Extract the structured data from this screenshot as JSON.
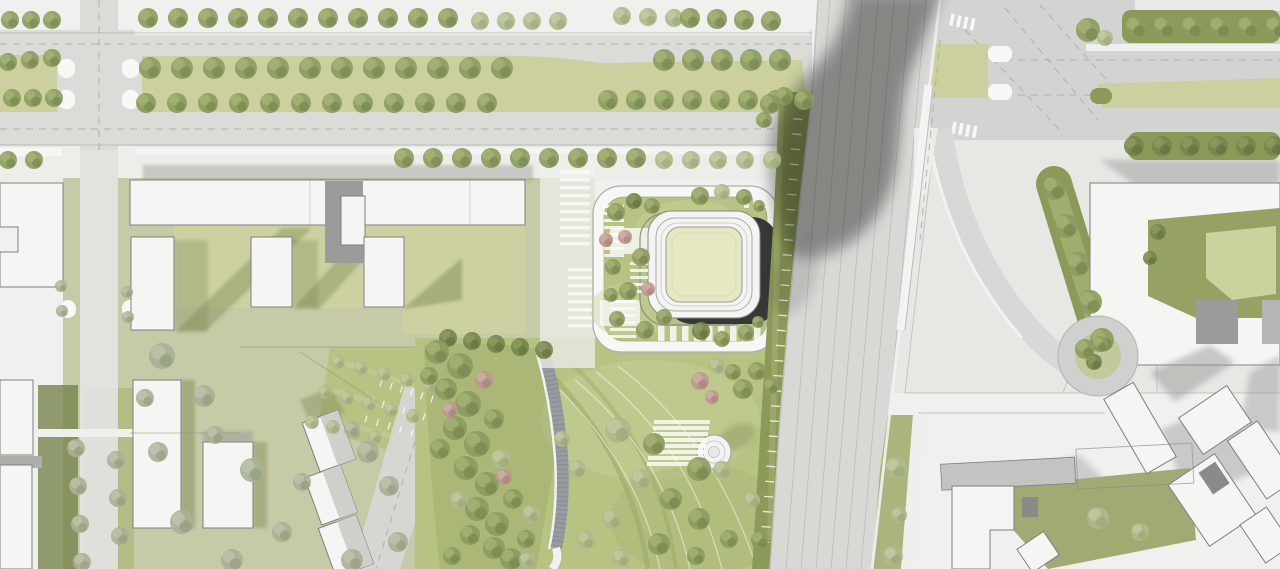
{
  "scene": {
    "kind": "architectural-site-plan",
    "description": "aerial-masterplan-rendering",
    "width": 1280,
    "height": 569
  },
  "palette": {
    "bg": "#F0F0EE",
    "road": "#DBDCD8",
    "roadDark": "#D3D4D1",
    "white": "#F8F8F6",
    "building": "#F5F5F3",
    "buildingStroke": "#7E7F81",
    "grayRoof": "#C3C4C1",
    "grayShadow": "#9A9A98",
    "oliveShadow": "#77854E",
    "lawnYellow": "#CBD09E",
    "lawnSage": "#C6CAA7",
    "lawnBright": "#B7C382",
    "lawnMid": "#AFBA80",
    "hedge": "#8B9A58",
    "courtyard": "#E5E8C3",
    "darkFacade": "#373736",
    "gravel": "#969CA0",
    "lineGray": "#A7A8A4",
    "towerShadow": "#6B6B69"
  },
  "vegetation": {
    "tree_types": {
      "olive": {
        "fill": "#8C9B60",
        "hi": "#A9B878",
        "sh": "#6F7E48"
      },
      "light": {
        "fill": "#AFBA8C",
        "hi": "#C6CEA6",
        "sh": "#95A172"
      },
      "gray": {
        "fill": "#A9B195",
        "hi": "#C2C8B0",
        "sh": "#8C957A"
      },
      "pink": {
        "fill": "#BD9890",
        "hi": "#D2B3AB",
        "sh": "#A07B73"
      },
      "dark": {
        "fill": "#76864C",
        "hi": "#8FA063",
        "sh": "#5C6B3A"
      }
    },
    "tree_rows": [
      {
        "x": 10,
        "y": 20,
        "dx": 21,
        "dy": 0,
        "n": 3,
        "r": 9,
        "t": "olive"
      },
      {
        "x": 148,
        "y": 18,
        "dx": 30,
        "dy": 0,
        "n": 11,
        "r": 10,
        "t": "olive"
      },
      {
        "x": 480,
        "y": 21,
        "dx": 26,
        "dy": 0,
        "n": 4,
        "r": 9,
        "t": "light"
      },
      {
        "x": 622,
        "y": 16,
        "dx": 26,
        "dy": 1,
        "n": 3,
        "r": 9,
        "t": "light"
      },
      {
        "x": 690,
        "y": 18,
        "dx": 27,
        "dy": 1,
        "n": 4,
        "r": 10,
        "t": "olive"
      },
      {
        "x": 8,
        "y": 62,
        "dx": 22,
        "dy": -2,
        "n": 3,
        "r": 9,
        "t": "olive"
      },
      {
        "x": 12,
        "y": 98,
        "dx": 21,
        "dy": 0,
        "n": 3,
        "r": 9,
        "t": "olive"
      },
      {
        "x": 150,
        "y": 68,
        "dx": 32,
        "dy": 0,
        "n": 12,
        "r": 11,
        "t": "olive"
      },
      {
        "x": 146,
        "y": 103,
        "dx": 31,
        "dy": 0,
        "n": 12,
        "r": 10,
        "t": "olive"
      },
      {
        "x": 664,
        "y": 60,
        "dx": 29,
        "dy": 0,
        "n": 5,
        "r": 11,
        "t": "olive"
      },
      {
        "x": 608,
        "y": 100,
        "dx": 28,
        "dy": 0,
        "n": 8,
        "r": 10,
        "t": "olive"
      },
      {
        "x": 8,
        "y": 160,
        "dx": 26,
        "dy": 0,
        "n": 2,
        "r": 9,
        "t": "olive"
      },
      {
        "x": 404,
        "y": 158,
        "dx": 29,
        "dy": 0,
        "n": 9,
        "r": 10,
        "t": "olive"
      },
      {
        "x": 664,
        "y": 160,
        "dx": 27,
        "dy": 0,
        "n": 5,
        "r": 9,
        "t": "light"
      },
      {
        "x": 1136,
        "y": 27,
        "dx": 28,
        "dy": 0,
        "n": 6,
        "r": 11,
        "t": "olive"
      },
      {
        "x": 1134,
        "y": 146,
        "dx": 28,
        "dy": 0,
        "n": 6,
        "r": 10,
        "t": "dark"
      },
      {
        "x": 1054,
        "y": 188,
        "dx": 12,
        "dy": 38,
        "n": 5,
        "r": 12,
        "t": "olive"
      },
      {
        "x": 61,
        "y": 286,
        "dx": 1,
        "dy": 25,
        "n": 2,
        "r": 6,
        "t": "gray"
      },
      {
        "x": 127,
        "y": 292,
        "dx": 1,
        "dy": 25,
        "n": 2,
        "r": 6,
        "t": "gray"
      },
      {
        "x": 76,
        "y": 448,
        "dx": 2,
        "dy": 38,
        "n": 4,
        "r": 9,
        "t": "gray"
      },
      {
        "x": 116,
        "y": 460,
        "dx": 2,
        "dy": 38,
        "n": 3,
        "r": 9,
        "t": "gray"
      },
      {
        "x": 338,
        "y": 362,
        "dx": 23,
        "dy": 6,
        "n": 5,
        "r": 7,
        "t": "light"
      },
      {
        "x": 325,
        "y": 392,
        "dx": 22,
        "dy": 6,
        "n": 5,
        "r": 7,
        "t": "light"
      },
      {
        "x": 312,
        "y": 422,
        "dx": 21,
        "dy": 5,
        "n": 4,
        "r": 7,
        "t": "light"
      },
      {
        "x": 448,
        "y": 338,
        "dx": 24,
        "dy": 3,
        "n": 5,
        "r": 9,
        "t": "dark"
      }
    ],
    "trees": [
      [
        616,
        212,
        9,
        "olive"
      ],
      [
        634,
        201,
        8,
        "dark"
      ],
      [
        652,
        206,
        8,
        "olive"
      ],
      [
        606,
        240,
        7,
        "pink"
      ],
      [
        625,
        237,
        7,
        "pink"
      ],
      [
        641,
        257,
        9,
        "olive"
      ],
      [
        613,
        267,
        8,
        "olive"
      ],
      [
        611,
        295,
        7,
        "olive"
      ],
      [
        628,
        291,
        9,
        "olive"
      ],
      [
        617,
        319,
        8,
        "olive"
      ],
      [
        645,
        330,
        9,
        "olive"
      ],
      [
        664,
        317,
        8,
        "olive"
      ],
      [
        648,
        289,
        7,
        "pink"
      ],
      [
        700,
        196,
        9,
        "olive"
      ],
      [
        722,
        192,
        8,
        "light"
      ],
      [
        744,
        197,
        8,
        "olive"
      ],
      [
        759,
        206,
        6,
        "olive"
      ],
      [
        701,
        331,
        9,
        "dark"
      ],
      [
        722,
        339,
        8,
        "olive"
      ],
      [
        746,
        333,
        8,
        "olive"
      ],
      [
        758,
        322,
        6,
        "olive"
      ],
      [
        700,
        381,
        9,
        "pink"
      ],
      [
        717,
        366,
        8,
        "light"
      ],
      [
        743,
        389,
        10,
        "olive"
      ],
      [
        712,
        397,
        7,
        "pink"
      ],
      [
        733,
        372,
        8,
        "olive"
      ],
      [
        757,
        371,
        9,
        "olive"
      ],
      [
        771,
        386,
        8,
        "olive"
      ],
      [
        437,
        352,
        12,
        "olive"
      ],
      [
        460,
        366,
        13,
        "olive"
      ],
      [
        446,
        389,
        11,
        "olive"
      ],
      [
        468,
        404,
        13,
        "olive"
      ],
      [
        484,
        380,
        9,
        "pink"
      ],
      [
        455,
        428,
        12,
        "olive"
      ],
      [
        477,
        444,
        13,
        "olive"
      ],
      [
        494,
        419,
        10,
        "olive"
      ],
      [
        466,
        468,
        12,
        "olive"
      ],
      [
        487,
        484,
        12,
        "olive"
      ],
      [
        501,
        459,
        10,
        "light"
      ],
      [
        477,
        509,
        12,
        "olive"
      ],
      [
        497,
        524,
        12,
        "olive"
      ],
      [
        513,
        499,
        10,
        "olive"
      ],
      [
        494,
        548,
        11,
        "olive"
      ],
      [
        511,
        559,
        11,
        "olive"
      ],
      [
        526,
        539,
        9,
        "olive"
      ],
      [
        450,
        410,
        8,
        "pink"
      ],
      [
        504,
        477,
        8,
        "pink"
      ],
      [
        531,
        514,
        9,
        "light"
      ],
      [
        440,
        449,
        10,
        "olive"
      ],
      [
        459,
        500,
        9,
        "light"
      ],
      [
        470,
        535,
        10,
        "olive"
      ],
      [
        452,
        556,
        9,
        "olive"
      ],
      [
        429,
        376,
        9,
        "olive"
      ],
      [
        527,
        560,
        8,
        "light"
      ],
      [
        618,
        430,
        13,
        "light"
      ],
      [
        654,
        444,
        11,
        "olive"
      ],
      [
        699,
        469,
        12,
        "olive"
      ],
      [
        641,
        479,
        10,
        "light"
      ],
      [
        671,
        499,
        11,
        "olive"
      ],
      [
        612,
        519,
        10,
        "light"
      ],
      [
        699,
        519,
        11,
        "olive"
      ],
      [
        729,
        539,
        9,
        "olive"
      ],
      [
        659,
        544,
        11,
        "olive"
      ],
      [
        621,
        558,
        9,
        "light"
      ],
      [
        577,
        469,
        9,
        "light"
      ],
      [
        562,
        439,
        8,
        "light"
      ],
      [
        586,
        540,
        9,
        "light"
      ],
      [
        722,
        470,
        9,
        "light"
      ],
      [
        752,
        500,
        8,
        "light"
      ],
      [
        760,
        540,
        9,
        "olive"
      ],
      [
        696,
        556,
        9,
        "olive"
      ],
      [
        162,
        356,
        13,
        "gray"
      ],
      [
        204,
        396,
        11,
        "gray"
      ],
      [
        158,
        452,
        10,
        "gray"
      ],
      [
        252,
        470,
        12,
        "gray"
      ],
      [
        182,
        522,
        12,
        "gray"
      ],
      [
        282,
        532,
        10,
        "gray"
      ],
      [
        232,
        560,
        11,
        "gray"
      ],
      [
        302,
        482,
        9,
        "gray"
      ],
      [
        352,
        560,
        11,
        "gray"
      ],
      [
        398,
        542,
        10,
        "gray"
      ],
      [
        145,
        398,
        9,
        "gray"
      ],
      [
        215,
        435,
        9,
        "gray"
      ],
      [
        368,
        452,
        11,
        "gray"
      ],
      [
        389,
        486,
        10,
        "gray"
      ],
      [
        352,
        429,
        8,
        "gray"
      ],
      [
        1085,
        349,
        10,
        "olive"
      ],
      [
        1100,
        344,
        8,
        "olive"
      ],
      [
        1094,
        362,
        8,
        "dark"
      ],
      [
        1158,
        232,
        8,
        "dark"
      ],
      [
        1150,
        258,
        7,
        "dark"
      ],
      [
        896,
        468,
        11,
        "light"
      ],
      [
        893,
        556,
        10,
        "light"
      ],
      [
        899,
        515,
        8,
        "light"
      ],
      [
        1098,
        518,
        11,
        "light"
      ],
      [
        1140,
        532,
        9,
        "light"
      ],
      [
        1088,
        30,
        12,
        "olive"
      ],
      [
        1105,
        38,
        8,
        "light"
      ],
      [
        770,
        104,
        10,
        "olive"
      ],
      [
        784,
        96,
        9,
        "olive"
      ],
      [
        764,
        120,
        8,
        "olive"
      ]
    ]
  },
  "markings": {
    "tick_rows": [
      {
        "x1": 799,
        "y1": 104,
        "x2": 765,
        "y2": 542,
        "n": 30,
        "len": 9
      },
      {
        "x1": 381,
        "y1": 383,
        "x2": 432,
        "y2": 399,
        "n": 6,
        "len": 7
      },
      {
        "x1": 373,
        "y1": 401,
        "x2": 424,
        "y2": 417,
        "n": 6,
        "len": 7
      },
      {
        "x1": 366,
        "y1": 419,
        "x2": 412,
        "y2": 433,
        "n": 5,
        "len": 7
      }
    ],
    "bar_rows": [
      {
        "x": 560,
        "y": 170,
        "w": 30,
        "h": 3.5,
        "n": 10,
        "dx": 0,
        "dy": 8
      },
      {
        "x": 568,
        "y": 268,
        "w": 24,
        "h": 3.5,
        "n": 8,
        "dx": 0,
        "dy": 8
      },
      {
        "x": 604,
        "y": 205,
        "w": 20,
        "h": 3,
        "n": 8,
        "dx": 0,
        "dy": 7
      },
      {
        "x": 610,
        "y": 300,
        "w": 26,
        "h": 3,
        "n": 6,
        "dx": 0,
        "dy": 7
      },
      {
        "x": 630,
        "y": 262,
        "w": 18,
        "h": 3,
        "n": 5,
        "dx": 0,
        "dy": 7
      },
      {
        "x": 658,
        "y": 326,
        "w": 6.5,
        "h": 15,
        "n": 9,
        "dx": 12,
        "dy": 0
      },
      {
        "x": 744,
        "y": 196,
        "w": 5,
        "h": 12,
        "n": 3,
        "dx": 9,
        "dy": 0
      },
      {
        "x": 654,
        "y": 420,
        "w": 56,
        "h": 4,
        "n": 8,
        "dx": -1,
        "dy": 6
      }
    ]
  }
}
